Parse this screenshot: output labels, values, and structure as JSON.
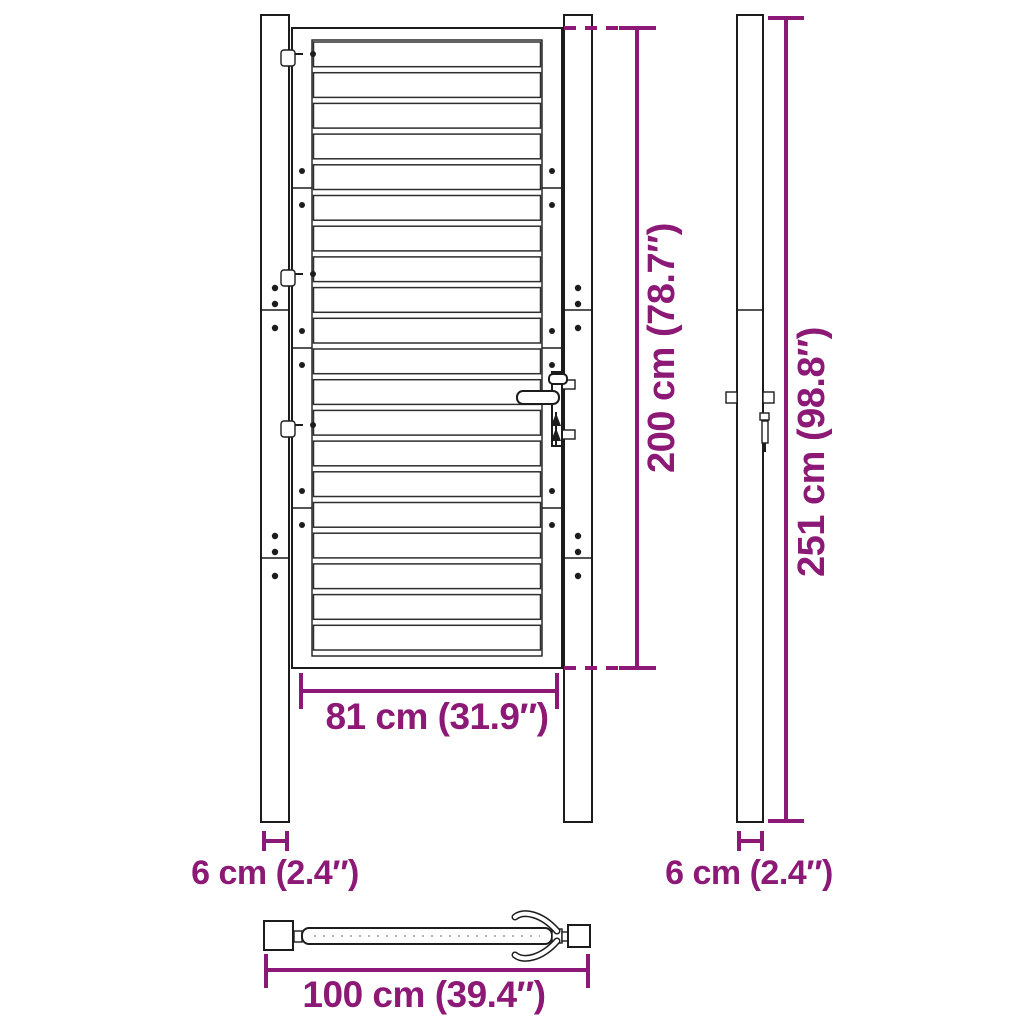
{
  "diagram": {
    "accent_color": "#8c1976",
    "line_color": "#1c1c1c",
    "dimensions": {
      "gate_height": "200 cm (78.7″)",
      "gate_width": "81 cm (31.9″)",
      "post_width_front": "6 cm (2.4″)",
      "post_height": "251 cm (98.8″)",
      "post_width_side": "6 cm (2.4″)",
      "total_width": "100 cm (39.4″)"
    }
  }
}
